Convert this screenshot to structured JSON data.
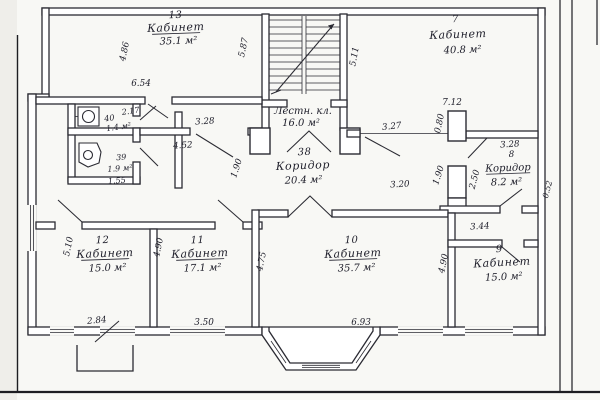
{
  "document": {
    "kind": "scanned architectural floor plan",
    "language": "ru",
    "ink_color": "#2b2b33",
    "paper_color": "#f8f8f5"
  },
  "labels": {
    "room13": {
      "number": "13",
      "name": "Кабинет",
      "area": "35.1 м²"
    },
    "staircase": {
      "name": "Лестн. кл.",
      "area": "16.0 м²"
    },
    "room7": {
      "number": "7",
      "name": "Кабинет",
      "area": "40.8 м²"
    },
    "corridor38": {
      "number": "38",
      "name": "Коридор",
      "area": "20.4 м²"
    },
    "corridor8": {
      "number": "8",
      "name": "Коридор",
      "area": "8.2 м²"
    },
    "wc40": {
      "number": "40",
      "area": "1.4 м²",
      "width": "2.17"
    },
    "wc39": {
      "number": "39",
      "area": "1.9 м²",
      "width": "1.55"
    },
    "room12": {
      "number": "12",
      "name": "Кабинет",
      "area": "15.0 м²"
    },
    "room11": {
      "number": "11",
      "name": "Кабинет",
      "area": "17.1 м²"
    },
    "room10": {
      "number": "10",
      "name": "Кабинет",
      "area": "35.7 м²"
    },
    "room9": {
      "number": "9",
      "name": "Кабинет",
      "area": "15.0 м²"
    }
  },
  "dimensions_m": {
    "room13_side": "4.86",
    "room13_width": "6.54",
    "stair_left": "5.87",
    "stair_right": "5.11",
    "lobby_top": "3.28",
    "lobby_opening": "4.52",
    "corridor_left_pier": "1.90",
    "room7_opening": "3.27",
    "room7_pier": "0.80",
    "room7_width": "7.12",
    "corridor8_pier": "1.90",
    "corridor8_side": "2.50",
    "corridor8_width": "3.28",
    "corridor8_niche": "0.52",
    "corridor_opening": "3.20",
    "room9_lobby": "3.44",
    "room12_side": "5.10",
    "room11_side": "4.90",
    "room12_window": "2.84",
    "room11_window": "3.50",
    "room10_side": "4.75",
    "room9_side": "4.90",
    "room10_width": "6.93"
  }
}
